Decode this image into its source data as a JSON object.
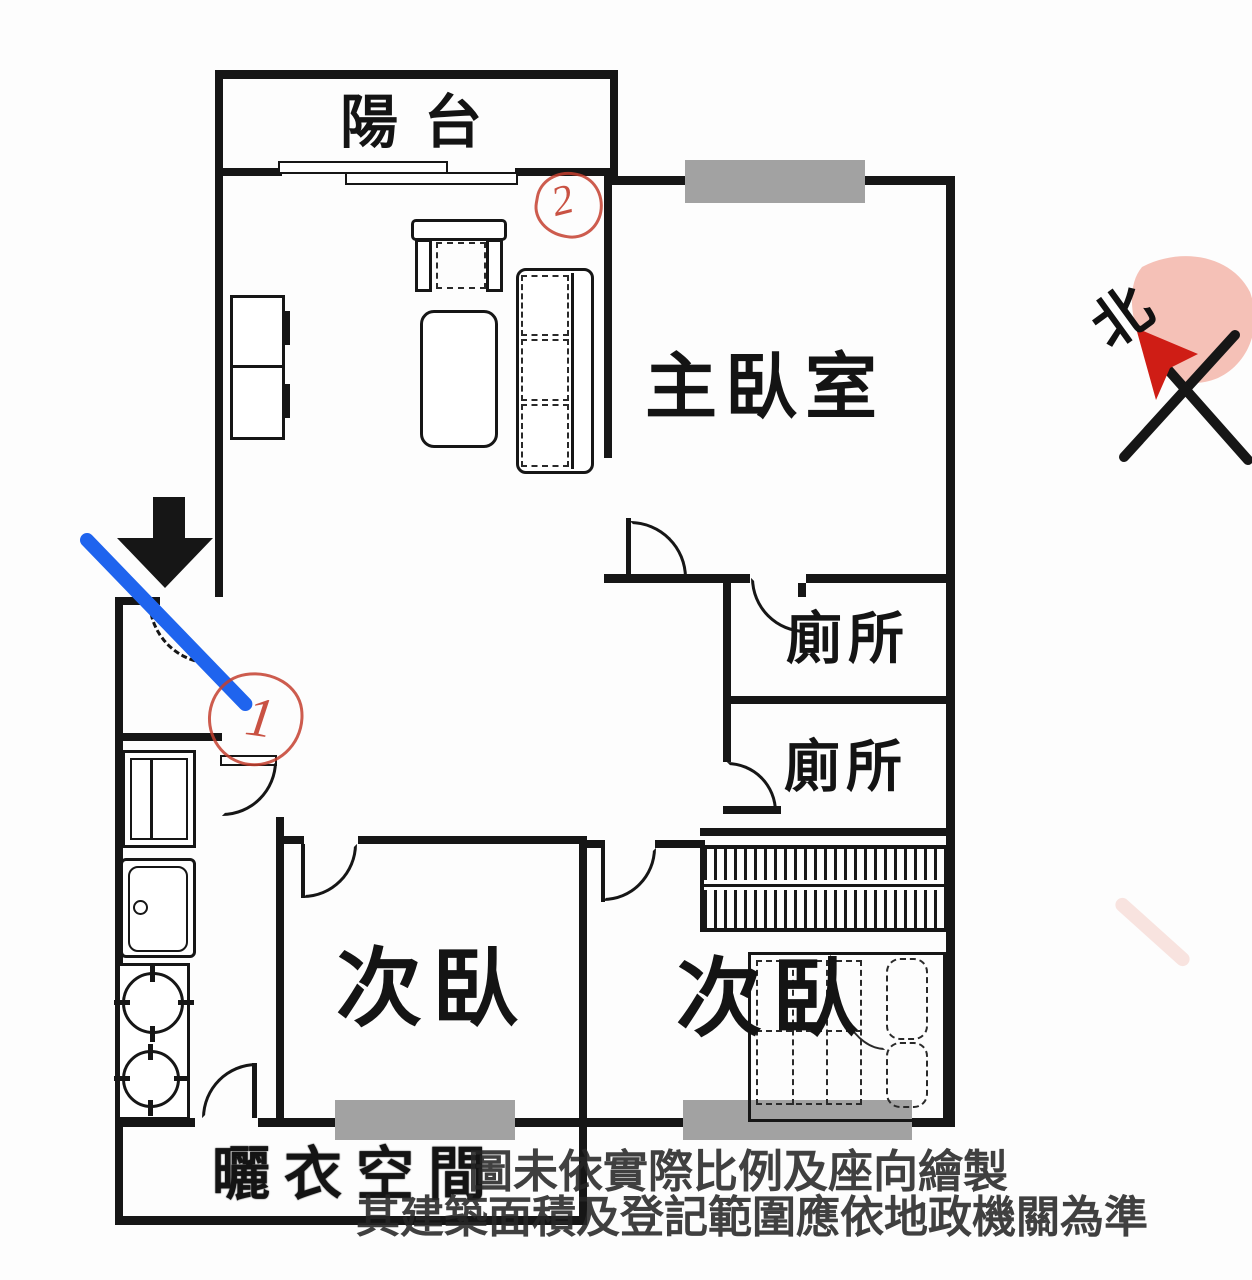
{
  "plan": {
    "rooms": {
      "balcony": {
        "label": "陽台"
      },
      "master_bedroom": {
        "label": "主臥室"
      },
      "toilet_upper": {
        "label": "廁所"
      },
      "toilet_lower": {
        "label": "廁所"
      },
      "bedroom_left": {
        "label": "次臥"
      },
      "bedroom_right": {
        "label": "次臥"
      },
      "laundry": {
        "label": "曬衣空間"
      }
    },
    "compass": {
      "label": "北"
    },
    "annotations": {
      "marker1": {
        "digit": "1"
      },
      "marker2": {
        "digit": "2"
      }
    },
    "disclaimer": {
      "line1": "圖未依實際比例及座向繪製",
      "line2": "其建築面積及登記範圍應依地政機關為準"
    },
    "colors": {
      "wall": "#161616",
      "window_gray": "#a2a2a2",
      "annotation_red": "#c4402f",
      "annotation_blue": "#1f64ee",
      "highlight_pink": "#f4bcb1"
    }
  }
}
